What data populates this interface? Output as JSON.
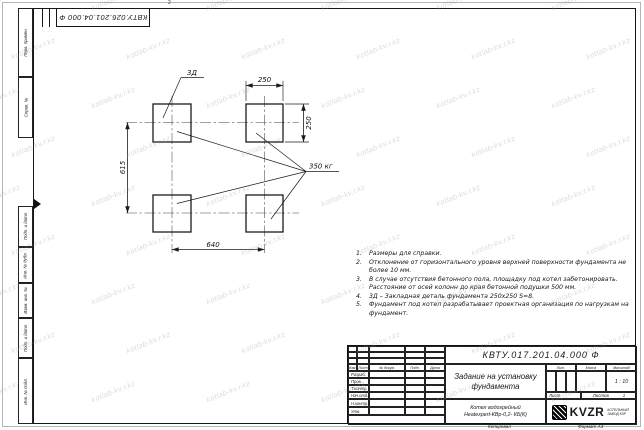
{
  "watermark": {
    "text": "kotlab-kv.r.kz"
  },
  "zone_marks": {
    "top": "2"
  },
  "corner_stamp": {
    "number": "КВТУ.026.201.04.000 Ф"
  },
  "margin_labels": {
    "perv": "Перв. примен.",
    "sprav": "Справ. №",
    "podp1": "Подп. и дата",
    "inv_dubl": "Инв. № дубл.",
    "vzam": "Взам. инв. №",
    "podp2": "Подп. и дата",
    "inv_podl": "Инв. № подл."
  },
  "drawing": {
    "labels": {
      "detail": "3Д",
      "load": "350 кг"
    },
    "dimensions": {
      "pad_width": "250",
      "pad_height": "250",
      "span_vertical": "615",
      "span_horizontal": "640"
    }
  },
  "notes": {
    "items": [
      {
        "num": "1.",
        "text": "Размеры для справки."
      },
      {
        "num": "2.",
        "text": "Отклонение от горизонтального уровня верхней поверхности фундамента не более 10 мм."
      },
      {
        "num": "3.",
        "text": "В случае отсутствия бетонного пола, площадку под котел забетонировать. Расстояние от осей колонн до края бетонной подушки 500 мм."
      },
      {
        "num": "4.",
        "text": "3Д – Закладная деталь фундамента 250х250 S=8."
      },
      {
        "num": "5.",
        "text": "Фундамент под котел разрабатывает проектная организация по нагрузкам на фундамент."
      }
    ]
  },
  "title_block": {
    "doc_number": "КВТУ.017.201.04.000 Ф",
    "title": "Задание на установку фундамента",
    "product_line1": "Котел водогрейный",
    "product_line2": "Heatexpert-КВр-0,2- КБ(К)",
    "columns": {
      "izm": "Изм.",
      "list": "Лист",
      "doc": "№ докум.",
      "podp": "Подп.",
      "data": "Дата"
    },
    "rows": {
      "razrab": "Разраб.",
      "prov": "Пров.",
      "tkontr": "Т.контр.",
      "nachotd": "Нач.отд.",
      "nkontr": "Н.контр.",
      "utv": "Утв."
    },
    "lit_label": "Лит.",
    "mass_label": "Масса",
    "scale_label": "Масштаб",
    "scale_value": "1 : 10",
    "sheet_label": "Лист",
    "sheets_label": "Листов",
    "sheets_value": "1",
    "logo_text": "KVZR",
    "logo_sub": "КОТЕЛЬНЫЙ ЗАВОД КЗР",
    "footer": {
      "copied": "Копировал",
      "format": "Формат А3"
    }
  }
}
